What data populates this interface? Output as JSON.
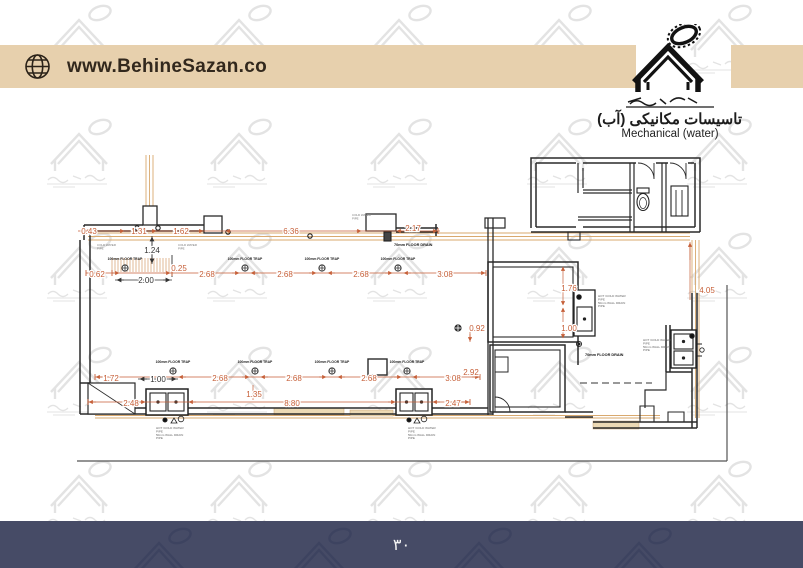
{
  "header": {
    "website": "www.BehineSazan.co",
    "banner_color": "#e7d0ad",
    "logo_icon": "behinesazan-house-logo",
    "title_fa": "تاسیسات مکانیکی (آب)",
    "subtitle_en": "Mechanical (water)"
  },
  "footer": {
    "page_number": "٣٠",
    "background_color": "#464b66"
  },
  "watermark": {
    "icon": "behinesazan-house-watermark",
    "color": "#e3e3e3"
  },
  "plan": {
    "colors": {
      "dimension": "#c65f38",
      "pipe": "#d9a96e",
      "wall": "#2a2a2a"
    },
    "dims": [
      "0.43",
      "1.31",
      "1.62",
      "6.36",
      "2.17",
      "1.24",
      "2.00",
      "1.00",
      "0.62",
      "0.25",
      "2.68",
      "2.68",
      "2.68",
      "3.08",
      "0.92",
      "1.76",
      "1.00",
      "4.05",
      "1.72",
      "2.68",
      "2.68",
      "2.68",
      "3.08",
      "2.92",
      "2.48",
      "1.35",
      "8.80",
      "2.47"
    ],
    "labels": {
      "floor_trap": "100mm FLOOR TRAP",
      "floor_drain": "70mm FLOOR DRAIN",
      "cold_water_line1": "COLD WATER",
      "cold_water_line2": "PIPE"
    },
    "annotation_lines": [
      "HOT /COLD WATER",
      "PIPE",
      "50mm WALL DRAIN",
      "PIPE"
    ]
  }
}
